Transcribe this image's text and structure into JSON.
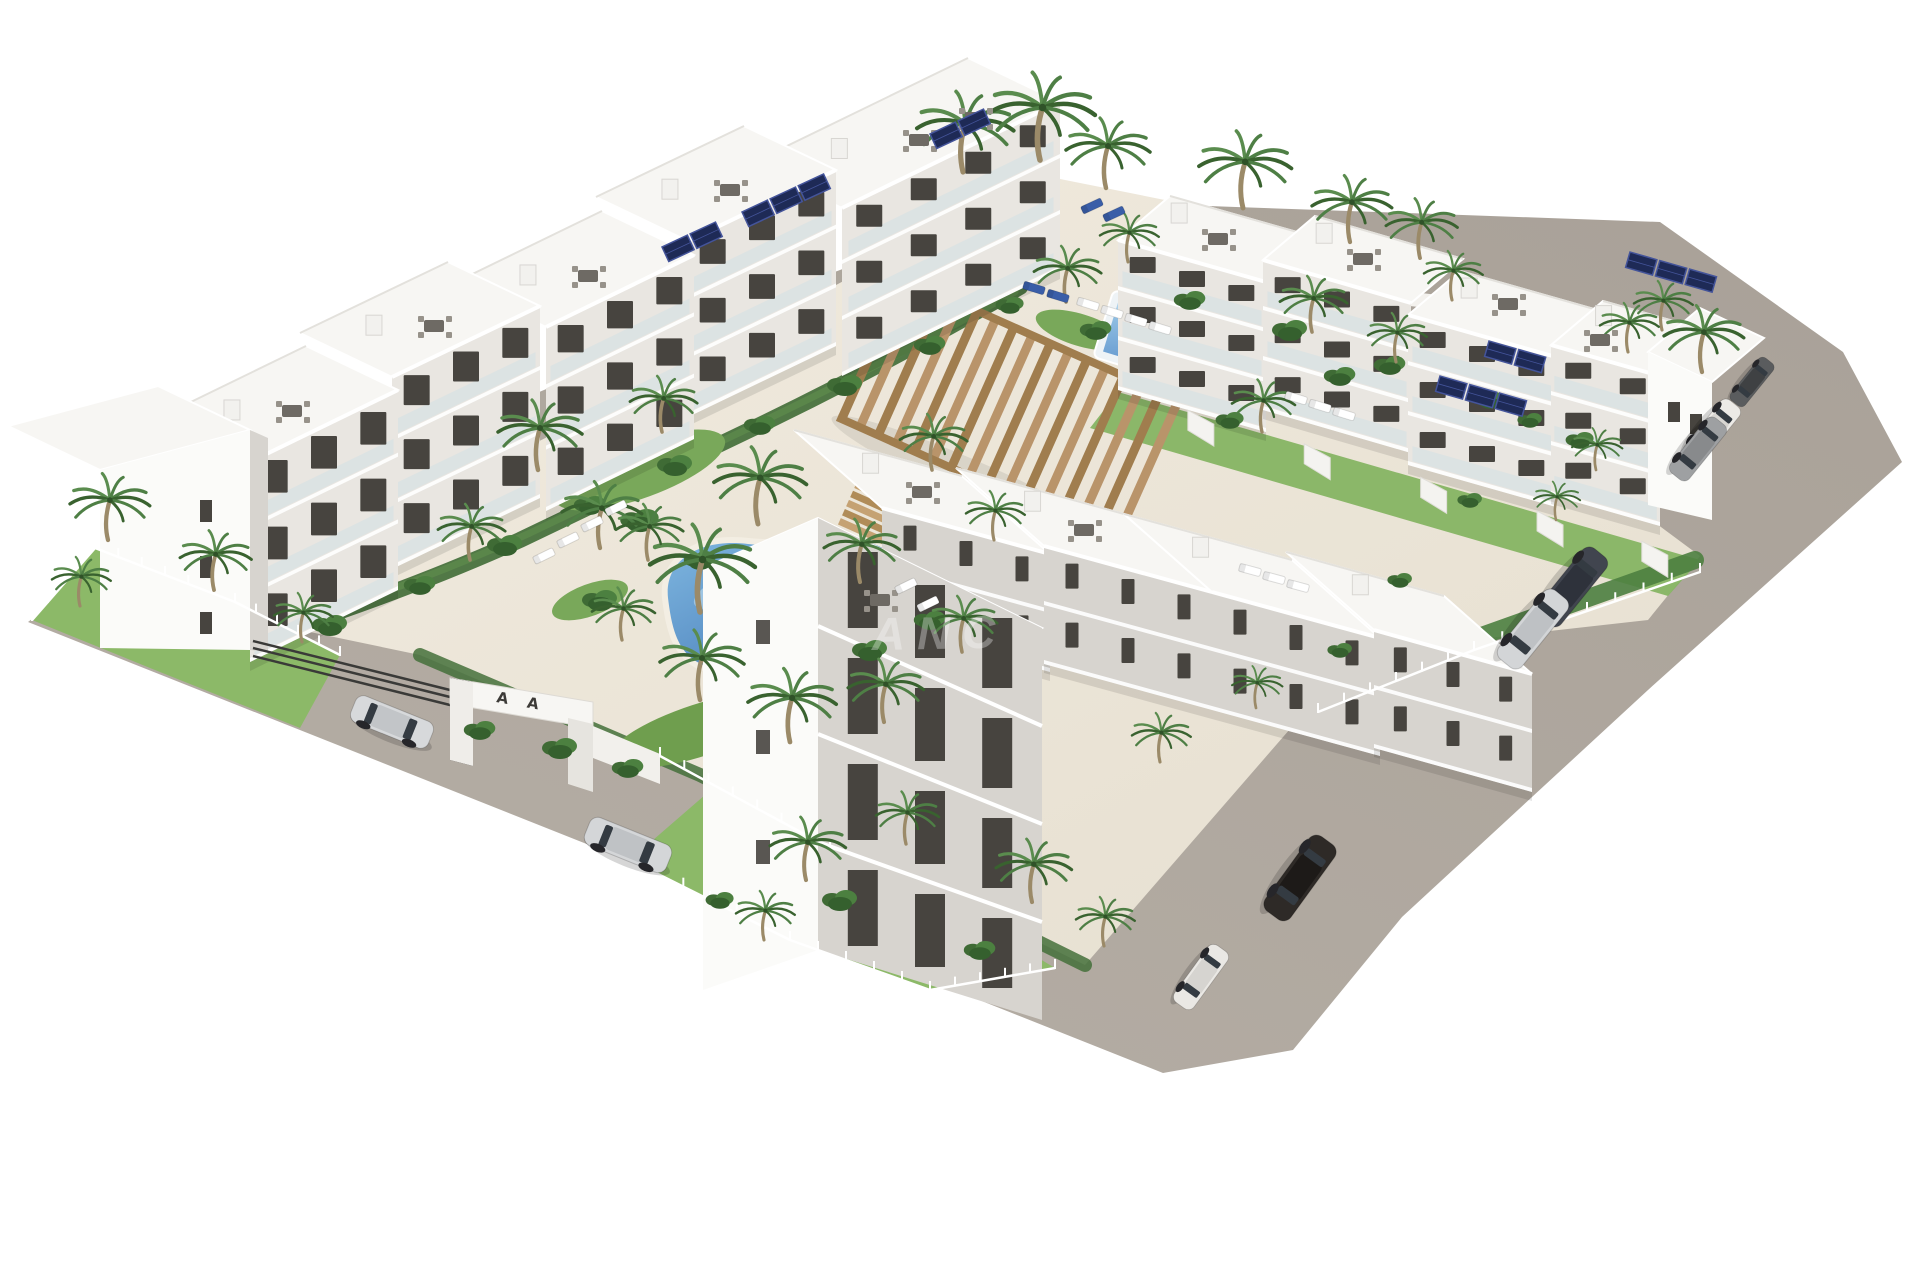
{
  "meta": {
    "type": "3d-architectural-render",
    "title": "Aerial render of white apartment residential complex",
    "description": "Bird's-eye 3D rendering of a Mediterranean-style residential development: white stepped apartment blocks with roof terraces and solar panels arranged around a landscaped courtyard with a freeform pool and a rectangular pool, wooden pergola, palm trees, perimeter asphalt road with parked cars and a white entrance gate."
  },
  "watermark": {
    "text": "ANC",
    "color": "#ffffff",
    "opacity": 0.32
  },
  "entrance_gate": {
    "marks": "A A"
  },
  "palette": {
    "sky": "#ffffff",
    "road": "#a59d94",
    "road_light": "#b6afa6",
    "courtyard": "#ece5d8",
    "grass": "#8cb968",
    "grass_dark": "#6f9e4e",
    "hedge": "#3f6b35",
    "hedge_light": "#5c8a4b",
    "palm_green": "#4e7f45",
    "palm_green_dark": "#39622f",
    "palm_trunk": "#9b8a68",
    "bld_white": "#f7f6f3",
    "bld_bright": "#fbfbf9",
    "bld_face": "#e9e6e1",
    "bld_face_shadow": "#d7d4cf",
    "window": "#47443f",
    "glass": "#cfe0e6",
    "pool_light": "#8fc0e6",
    "pool_deep": "#3f74b5",
    "pool_coping": "#f3eee3",
    "pergola_wood": "#b9946a",
    "pergola_wood_dark": "#a07d4e",
    "solar_panel": "#1e2a56",
    "solar_frame": "#44549a",
    "fence_dark": "#3a3a38",
    "furniture": "#6e6a64",
    "white": "#ffffff"
  },
  "scene": {
    "counts": {
      "apartment_blocks": 15,
      "swimming_pools": 2,
      "palm_trees": 43,
      "parked_cars": 9,
      "pergolas": 2,
      "solar_panel_arrays": 6,
      "roof_terraces": 13,
      "entrance_gates": 1
    },
    "cars": [
      {
        "name": "silver-suv-at-gate",
        "x": 392,
        "y": 722,
        "angle": 22,
        "scale": 0.95,
        "body": "#d7d9db",
        "roof": "#c2c5c8"
      },
      {
        "name": "silver-sedan-left-road",
        "x": 628,
        "y": 845,
        "angle": 22,
        "scale": 1.0,
        "body": "#d4d6d8",
        "roof": "#bfc2c5"
      },
      {
        "name": "dark-city-car-right-road",
        "x": 1752,
        "y": 382,
        "angle": 129,
        "scale": 0.62,
        "body": "#5a5c5e",
        "roof": "#3f4143"
      },
      {
        "name": "white-suv-right-road",
        "x": 1712,
        "y": 431,
        "angle": 129,
        "scale": 0.8,
        "body": "#eceae6",
        "roof": "#d8d6d2"
      },
      {
        "name": "gray-suv-right-road",
        "x": 1698,
        "y": 449,
        "angle": 129,
        "scale": 0.8,
        "body": "#9ea0a2",
        "roof": "#888a8c"
      },
      {
        "name": "dark-blue-sedan-right-road",
        "x": 1572,
        "y": 587,
        "angle": 129,
        "scale": 1.0,
        "body": "#41454f",
        "roof": "#2e323b"
      },
      {
        "name": "silver-sedan-right-road",
        "x": 1533,
        "y": 629,
        "angle": 129,
        "scale": 1.0,
        "body": "#d3d5d7",
        "roof": "#bec1c4"
      },
      {
        "name": "black-suv-bottom-road",
        "x": 1300,
        "y": 878,
        "angle": 126,
        "scale": 1.05,
        "body": "#2e2a27",
        "roof": "#1d1a18"
      },
      {
        "name": "white-city-car-bottom-road",
        "x": 1201,
        "y": 977,
        "angle": 126,
        "scale": 0.8,
        "body": "#eae8e4",
        "roof": "#d6d4d0"
      }
    ],
    "palms": [
      [
        963,
        172,
        1.15
      ],
      [
        1040,
        160,
        1.25
      ],
      [
        1106,
        188,
        1.0
      ],
      [
        1243,
        208,
        1.1
      ],
      [
        1350,
        242,
        0.95
      ],
      [
        1420,
        258,
        0.85
      ],
      [
        1452,
        300,
        0.7
      ],
      [
        1702,
        372,
        0.95
      ],
      [
        1662,
        330,
        0.7
      ],
      [
        538,
        470,
        1.0
      ],
      [
        600,
        548,
        0.95
      ],
      [
        662,
        432,
        0.8
      ],
      [
        758,
        524,
        1.1
      ],
      [
        860,
        582,
        0.9
      ],
      [
        932,
        470,
        0.8
      ],
      [
        994,
        540,
        0.7
      ],
      [
        700,
        700,
        1.0
      ],
      [
        790,
        742,
        1.05
      ],
      [
        884,
        722,
        0.9
      ],
      [
        962,
        652,
        0.8
      ],
      [
        622,
        640,
        0.75
      ],
      [
        470,
        560,
        0.8
      ],
      [
        700,
        612,
        1.25
      ],
      [
        648,
        560,
        0.8
      ],
      [
        108,
        540,
        0.95
      ],
      [
        80,
        606,
        0.7
      ],
      [
        214,
        590,
        0.85
      ],
      [
        302,
        642,
        0.7
      ],
      [
        806,
        880,
        0.9
      ],
      [
        906,
        844,
        0.75
      ],
      [
        1032,
        902,
        0.9
      ],
      [
        764,
        940,
        0.7
      ],
      [
        1104,
        946,
        0.7
      ],
      [
        1066,
        302,
        0.8
      ],
      [
        1128,
        262,
        0.7
      ],
      [
        1312,
        332,
        0.8
      ],
      [
        1396,
        362,
        0.7
      ],
      [
        1262,
        432,
        0.75
      ],
      [
        1628,
        352,
        0.7
      ],
      [
        1596,
        470,
        0.6
      ],
      [
        1556,
        520,
        0.55
      ],
      [
        1160,
        762,
        0.7
      ],
      [
        1256,
        708,
        0.6
      ]
    ],
    "bushes": [
      [
        330,
        625,
        1
      ],
      [
        420,
        585,
        0.9
      ],
      [
        505,
        545,
        1
      ],
      [
        590,
        505,
        0.9
      ],
      [
        675,
        465,
        1
      ],
      [
        760,
        425,
        0.9
      ],
      [
        845,
        385,
        1
      ],
      [
        930,
        345,
        0.9
      ],
      [
        1010,
        305,
        0.8
      ],
      [
        640,
        520,
        1.1
      ],
      [
        700,
        560,
        0.9
      ],
      [
        870,
        650,
        1
      ],
      [
        930,
        620,
        0.9
      ],
      [
        600,
        600,
        1
      ],
      [
        480,
        730,
        0.9
      ],
      [
        560,
        748,
        1
      ],
      [
        628,
        768,
        0.9
      ],
      [
        840,
        900,
        1
      ],
      [
        980,
        950,
        0.9
      ],
      [
        720,
        900,
        0.8
      ],
      [
        1190,
        300,
        0.9
      ],
      [
        1290,
        330,
        1
      ],
      [
        1390,
        365,
        0.9
      ],
      [
        1490,
        400,
        0.8
      ],
      [
        1580,
        440,
        0.8
      ],
      [
        1096,
        330,
        0.9
      ],
      [
        1340,
        376,
        0.9
      ],
      [
        1230,
        420,
        0.8
      ],
      [
        1530,
        420,
        0.7
      ],
      [
        1470,
        500,
        0.7
      ],
      [
        1400,
        580,
        0.7
      ],
      [
        1340,
        650,
        0.7
      ]
    ],
    "solar_panels": [
      {
        "x": 662,
        "y": 247,
        "angle": -25,
        "cols": 2
      },
      {
        "x": 742,
        "y": 212,
        "angle": -25,
        "cols": 3
      },
      {
        "x": 930,
        "y": 134,
        "angle": -25,
        "cols": 2
      },
      {
        "x": 1440,
        "y": 376,
        "angle": 16,
        "cols": 3
      },
      {
        "x": 1630,
        "y": 252,
        "angle": 16,
        "cols": 3
      },
      {
        "x": 1489,
        "y": 341,
        "angle": 16,
        "cols": 2
      }
    ],
    "roof_tables": [
      [
        292,
        411
      ],
      [
        434,
        326
      ],
      [
        588,
        276
      ],
      [
        730,
        190
      ],
      [
        919,
        140
      ],
      [
        975,
        118
      ],
      [
        1218,
        239
      ],
      [
        1363,
        259
      ],
      [
        1508,
        304
      ],
      [
        1600,
        340
      ],
      [
        922,
        492
      ],
      [
        1084,
        530
      ],
      [
        880,
        600
      ]
    ],
    "loungers": [
      {
        "x": 568,
        "y": 540,
        "angle": -26,
        "color": "#ffffff"
      },
      {
        "x": 592,
        "y": 524,
        "angle": -26,
        "color": "#ffffff"
      },
      {
        "x": 616,
        "y": 508,
        "angle": -26,
        "color": "#ffffff"
      },
      {
        "x": 544,
        "y": 556,
        "angle": -26,
        "color": "#ffffff"
      },
      {
        "x": 906,
        "y": 586,
        "angle": -26,
        "color": "#ffffff"
      },
      {
        "x": 928,
        "y": 604,
        "angle": -26,
        "color": "#ffffff"
      },
      {
        "x": 1112,
        "y": 312,
        "angle": 17,
        "color": "#ffffff"
      },
      {
        "x": 1136,
        "y": 320,
        "angle": 17,
        "color": "#ffffff"
      },
      {
        "x": 1160,
        "y": 328,
        "angle": 17,
        "color": "#ffffff"
      },
      {
        "x": 1088,
        "y": 304,
        "angle": 17,
        "color": "#ffffff"
      },
      {
        "x": 1296,
        "y": 398,
        "angle": 17,
        "color": "#ffffff"
      },
      {
        "x": 1320,
        "y": 406,
        "angle": 17,
        "color": "#ffffff"
      },
      {
        "x": 1344,
        "y": 414,
        "angle": 17,
        "color": "#ffffff"
      },
      {
        "x": 1058,
        "y": 296,
        "angle": 17,
        "color": "#3a5ea8"
      },
      {
        "x": 1034,
        "y": 288,
        "angle": 17,
        "color": "#3a5ea8"
      },
      {
        "x": 1250,
        "y": 570,
        "angle": 15,
        "color": "#ffffff"
      },
      {
        "x": 1274,
        "y": 578,
        "angle": 15,
        "color": "#ffffff"
      },
      {
        "x": 1298,
        "y": 586,
        "angle": 15,
        "color": "#ffffff"
      },
      {
        "x": 1092,
        "y": 206,
        "angle": -25,
        "color": "#3a5ea8"
      },
      {
        "x": 1114,
        "y": 214,
        "angle": -25,
        "color": "#3a5ea8"
      }
    ]
  }
}
